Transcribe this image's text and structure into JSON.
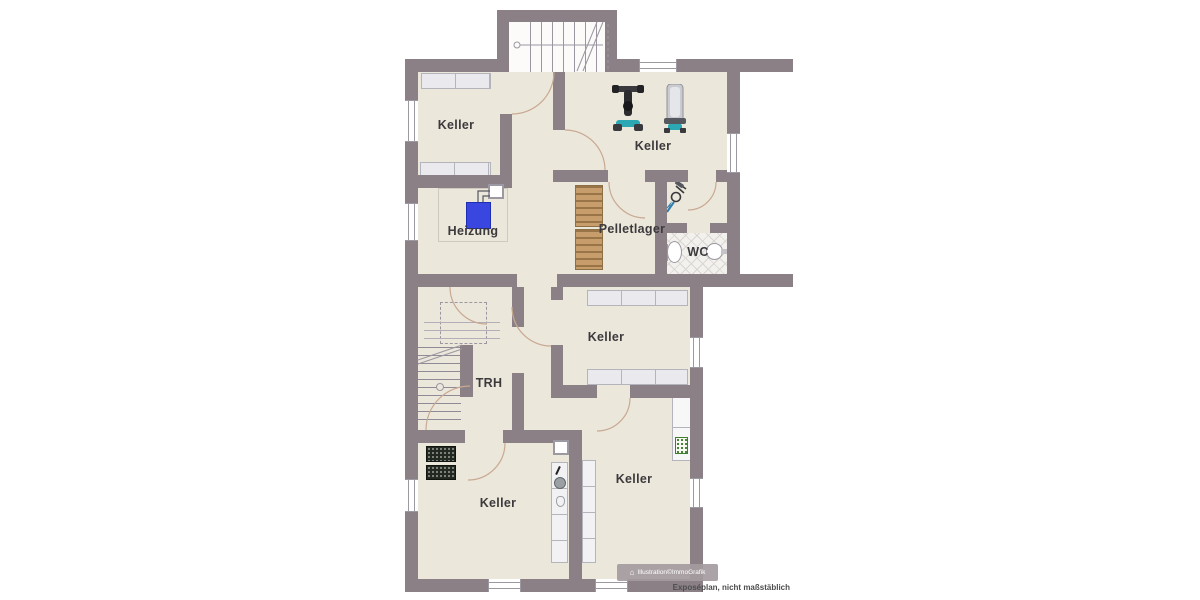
{
  "plan": {
    "title": "Kellergeschoss Grundriss",
    "watermark": "Illustration©ImmoGrafik",
    "disclaimer": "Exposéplan, nicht maßstäblich"
  },
  "rooms": [
    {
      "id": "keller-top-left",
      "label": "Keller"
    },
    {
      "id": "keller-gym",
      "label": "Keller"
    },
    {
      "id": "heizung",
      "label": "Heizung"
    },
    {
      "id": "pelletlager",
      "label": "Pelletlager"
    },
    {
      "id": "wc",
      "label": "WC"
    },
    {
      "id": "trh",
      "label": "TRH"
    },
    {
      "id": "keller-middle",
      "label": "Keller"
    },
    {
      "id": "keller-bottom-left",
      "label": "Keller"
    },
    {
      "id": "keller-bottom-right",
      "label": "Keller"
    }
  ],
  "icons": [
    "staircase-icon",
    "gym-machine-icon",
    "pallet-icon",
    "heater-icon",
    "chimney-icon",
    "toilet-icon",
    "washbasin-icon",
    "sink-icon",
    "wine-rack-icon",
    "fridge-icon",
    "shelf-unit-icon",
    "window-icon",
    "door-swing-icon",
    "house-icon"
  ],
  "colors": {
    "wall": "#8b8086",
    "floor": "#ece7db",
    "tile_line": "#d9d5d0",
    "heater_blue": "#3a46e0",
    "pallet_tan": "#c79e6b",
    "door_arc": "#c8a992",
    "wine_rack": "#232921",
    "gym_teal": "#2ba8b4",
    "label_text": "#3c3a3d"
  }
}
